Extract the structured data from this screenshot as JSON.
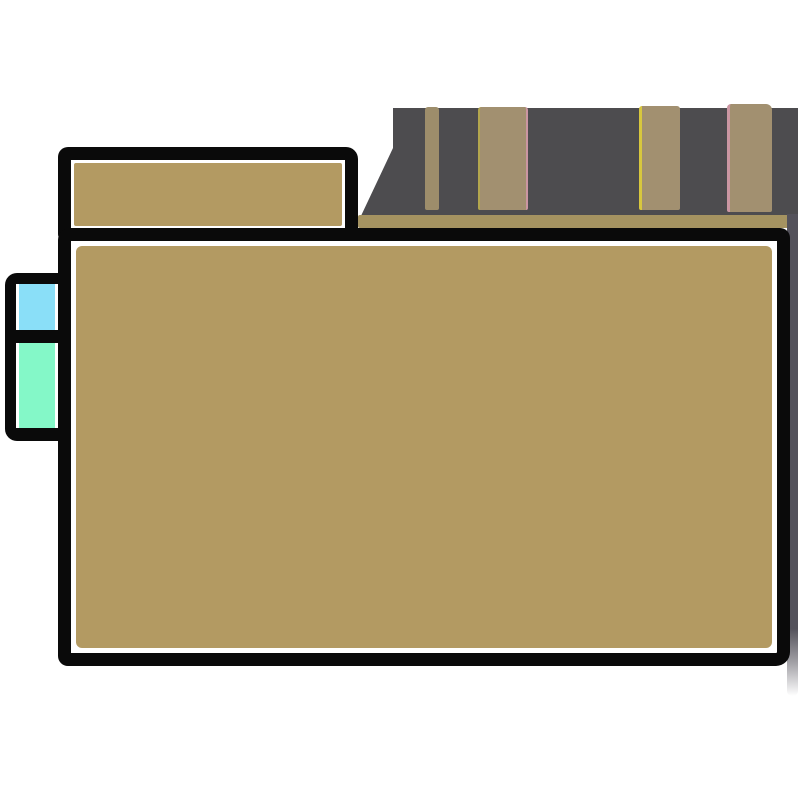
{
  "scene": {
    "type": "illustration",
    "description": "Hand-drawn style illustration with no text: a large tan folder/board outlined in thick black with a white inner line, a tan tab at its top-left, two small colored index tabs (cyan and mint) attached to its left edge, and a dark gray shelf band with tan book-spine stripes behind it at the top right, plus a gray shadow column along the right side.",
    "background": "#ffffff"
  },
  "palette": {
    "ink": "#0a0a0a",
    "paper": "#ffffff",
    "tan": "#b39a62",
    "tan-muted": "#a59361",
    "spine-tan": "#a29070",
    "spine-tan-dark": "#9d8d6b",
    "band-gray": "#4d4c4f",
    "shadow-gray": "#54525b",
    "edge-yellow": "#d8c73e",
    "edge-olive": "#b3a64e",
    "edge-pink": "#cb96a2",
    "tab-cyan": "#8adff8",
    "tab-mint": "#84f8c8"
  },
  "elements": [
    {
      "name": "shelf-band",
      "kind": "background-shape",
      "color_ref": "band-gray"
    },
    {
      "name": "book-spine-1",
      "kind": "stripe",
      "color_ref": "spine-tan-dark"
    },
    {
      "name": "book-spine-2",
      "kind": "stripe",
      "color_ref": "spine-tan",
      "edge_refs": [
        "edge-olive",
        "edge-pink"
      ]
    },
    {
      "name": "book-spine-3",
      "kind": "stripe",
      "color_ref": "spine-tan",
      "edge_refs": [
        "edge-yellow"
      ]
    },
    {
      "name": "book-spine-4",
      "kind": "stripe",
      "color_ref": "spine-tan",
      "edge_refs": [
        "edge-pink"
      ]
    },
    {
      "name": "shelf-edge-strip",
      "kind": "stripe",
      "color_ref": "tan-muted"
    },
    {
      "name": "right-shadow",
      "kind": "shadow",
      "color_ref": "shadow-gray"
    },
    {
      "name": "side-tab-cyan",
      "kind": "outlined-cell",
      "color_ref": "tab-cyan"
    },
    {
      "name": "side-tab-mint",
      "kind": "outlined-cell",
      "color_ref": "tab-mint"
    },
    {
      "name": "folder-tab",
      "kind": "outlined-shape",
      "fill_ref": "tan",
      "stroke_ref": "ink"
    },
    {
      "name": "folder-body",
      "kind": "outlined-shape",
      "fill_ref": "tan",
      "stroke_ref": "ink"
    }
  ]
}
